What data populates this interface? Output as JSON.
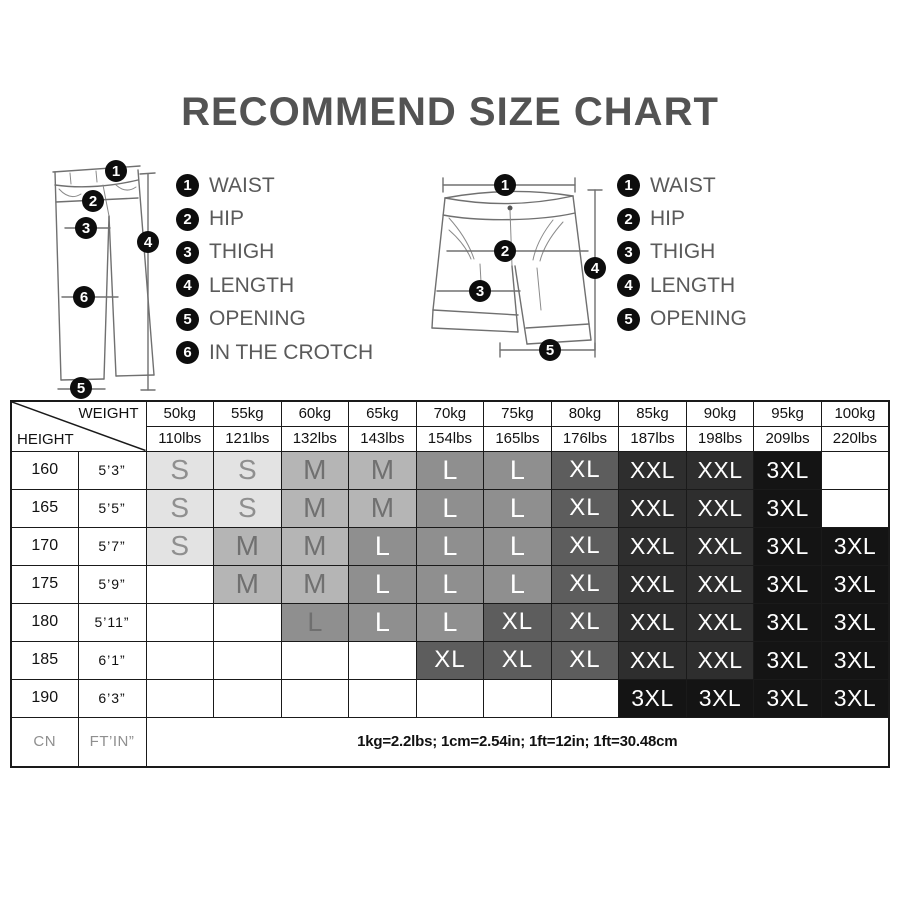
{
  "title": "RECOMMEND SIZE CHART",
  "pants_legend": [
    {
      "num": "1",
      "label": "WAIST"
    },
    {
      "num": "2",
      "label": "HIP"
    },
    {
      "num": "3",
      "label": "THIGH"
    },
    {
      "num": "4",
      "label": "LENGTH"
    },
    {
      "num": "5",
      "label": "OPENING"
    },
    {
      "num": "6",
      "label": "IN THE CROTCH"
    }
  ],
  "shorts_legend": [
    {
      "num": "1",
      "label": "WAIST"
    },
    {
      "num": "2",
      "label": "HIP"
    },
    {
      "num": "3",
      "label": "THIGH"
    },
    {
      "num": "4",
      "label": "LENGTH"
    },
    {
      "num": "5",
      "label": "OPENING"
    }
  ],
  "chart_data": {
    "type": "table",
    "title": "RECOMMEND SIZE CHART",
    "corner": {
      "top": "WEIGHT",
      "bottom": "HEIGHT"
    },
    "weights": [
      {
        "kg": "50kg",
        "lbs": "110lbs"
      },
      {
        "kg": "55kg",
        "lbs": "121lbs"
      },
      {
        "kg": "60kg",
        "lbs": "132lbs"
      },
      {
        "kg": "65kg",
        "lbs": "143lbs"
      },
      {
        "kg": "70kg",
        "lbs": "154lbs"
      },
      {
        "kg": "75kg",
        "lbs": "165lbs"
      },
      {
        "kg": "80kg",
        "lbs": "176lbs"
      },
      {
        "kg": "85kg",
        "lbs": "187lbs"
      },
      {
        "kg": "90kg",
        "lbs": "198lbs"
      },
      {
        "kg": "95kg",
        "lbs": "209lbs"
      },
      {
        "kg": "100kg",
        "lbs": "220lbs"
      }
    ],
    "rows": [
      {
        "cm": "160",
        "ftin": "5’3”",
        "sizes": [
          "S",
          "S",
          "M",
          "M",
          "L",
          "L",
          "XL",
          "XXL",
          "XXL",
          "3XL",
          ""
        ]
      },
      {
        "cm": "165",
        "ftin": "5’5”",
        "sizes": [
          "S",
          "S",
          "M",
          "M",
          "L",
          "L",
          "XL",
          "XXL",
          "XXL",
          "3XL",
          ""
        ]
      },
      {
        "cm": "170",
        "ftin": "5’7”",
        "sizes": [
          "S",
          "M",
          "M",
          "L",
          "L",
          "L",
          "XL",
          "XXL",
          "XXL",
          "3XL",
          "3XL"
        ]
      },
      {
        "cm": "175",
        "ftin": "5’9”",
        "sizes": [
          "",
          "M",
          "M",
          "L",
          "L",
          "L",
          "XL",
          "XXL",
          "XXL",
          "3XL",
          "3XL"
        ]
      },
      {
        "cm": "180",
        "ftin": "5’11”",
        "sizes": [
          "",
          "",
          "L",
          "L",
          "L",
          "XL",
          "XL",
          "XXL",
          "XXL",
          "3XL",
          "3XL"
        ]
      },
      {
        "cm": "185",
        "ftin": "6’1”",
        "sizes": [
          "",
          "",
          "",
          "",
          "XL",
          "XL",
          "XL",
          "XXL",
          "XXL",
          "3XL",
          "3XL"
        ]
      },
      {
        "cm": "190",
        "ftin": "6’3”",
        "sizes": [
          "",
          "",
          "",
          "",
          "",
          "",
          "",
          "3XL",
          "3XL",
          "3XL",
          "3XL"
        ]
      }
    ],
    "size_colors": {
      "S": {
        "bg": "#e3e3e3",
        "fg": "#8f8f8f"
      },
      "M": {
        "bg": "#b5b5b5",
        "fg": "#707070"
      },
      "L": {
        "bg": "#8f8f8f",
        "fg": "#ffffff"
      },
      "XL": {
        "bg": "#5d5d5d",
        "fg": "#ffffff"
      },
      "XXL": {
        "bg": "#2e2e2e",
        "fg": "#ffffff"
      },
      "3XL": {
        "bg": "#141414",
        "fg": "#ffffff"
      },
      "empty_bg": "#ffffff"
    },
    "dim_cell": {
      "row": 4,
      "col": 2,
      "fg": "#6f6f6f"
    },
    "footer": {
      "col1": "CN",
      "col2": "FT’IN”",
      "note": "1kg=2.2lbs; 1cm=2.54in; 1ft=12in; 1ft=30.48cm"
    }
  }
}
